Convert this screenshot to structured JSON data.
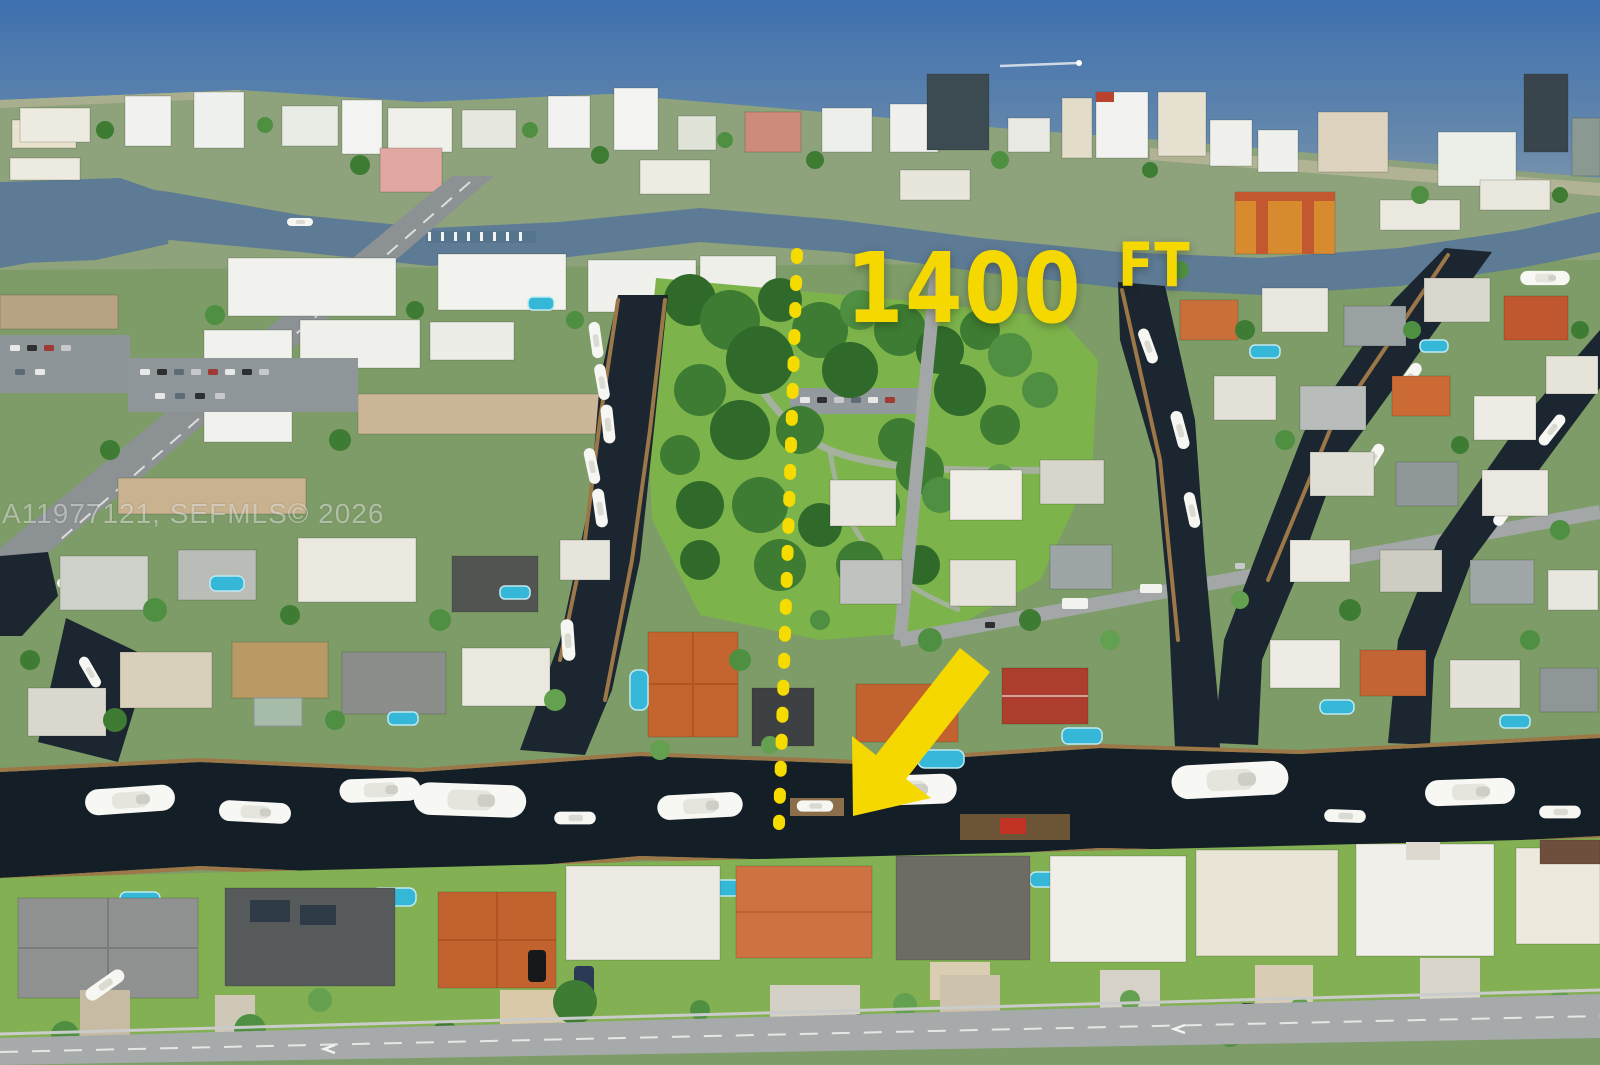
{
  "annotation": {
    "distance_number": "1400",
    "distance_unit": "FT",
    "color": "#F5D800",
    "elements": [
      "distance-label",
      "dashed-measure-line",
      "pointer-arrow"
    ]
  },
  "watermark": {
    "text": "A11977121, SEFMLS© 2026",
    "color": "rgba(255,255,255,0.45)"
  },
  "palette": {
    "annotation_yellow": "#F5D800",
    "ocean_top": "#3E70AF",
    "ocean_horizon": "#93A4AE",
    "intracoastal_water": "#5D7B95",
    "canal_water": "#141E26",
    "lawn_green": "#7CB34A",
    "tree_green": "#3D7C32",
    "pool_cyan": "#35B8D8",
    "roof_terracotta": "#C2622E",
    "roof_white": "#EDEAE3",
    "roof_orange_condo": "#D88A2E",
    "road_gray": "#A6AAAB",
    "beach_sand": "#D8C7A3"
  }
}
